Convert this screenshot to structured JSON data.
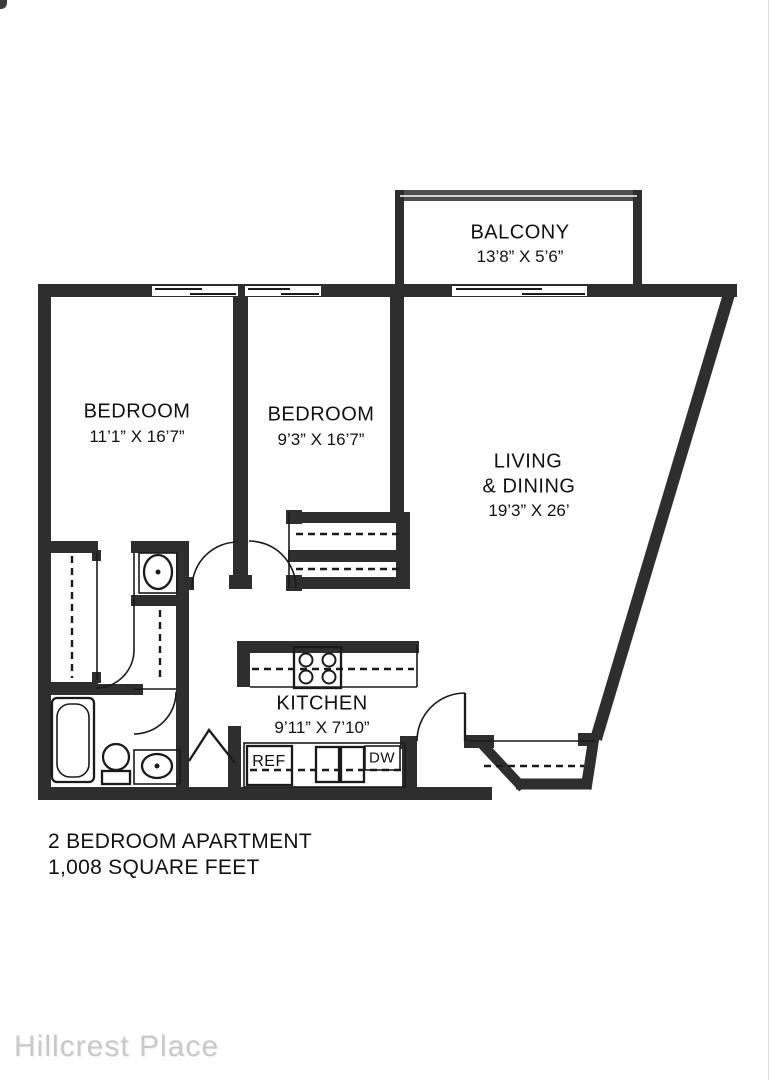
{
  "plan": {
    "balcony": {
      "label": "BALCONY",
      "dims": "13’8” X 5’6”"
    },
    "bedroom1": {
      "label": "BEDROOM",
      "dims": "11’1” X 16’7”"
    },
    "bedroom2": {
      "label": "BEDROOM",
      "dims": "9’3” X 16’7”"
    },
    "living": {
      "label_line1": "LIVING",
      "label_line2": "& DINING",
      "dims": "19’3” X 26’"
    },
    "kitchen": {
      "label": "KITCHEN",
      "dims": "9’11” X 7’10”"
    },
    "appliances": {
      "refrigerator": "REF",
      "dishwasher": "DW"
    }
  },
  "caption": {
    "line1": "2 BEDROOM APARTMENT",
    "line2": "1,008 SQUARE FEET"
  },
  "watermark": "Hillcrest Place",
  "colors": {
    "wall": "#2e2e2e",
    "line": "#1a1a1a",
    "text": "#111111",
    "watermark": "#c9c9c9"
  }
}
